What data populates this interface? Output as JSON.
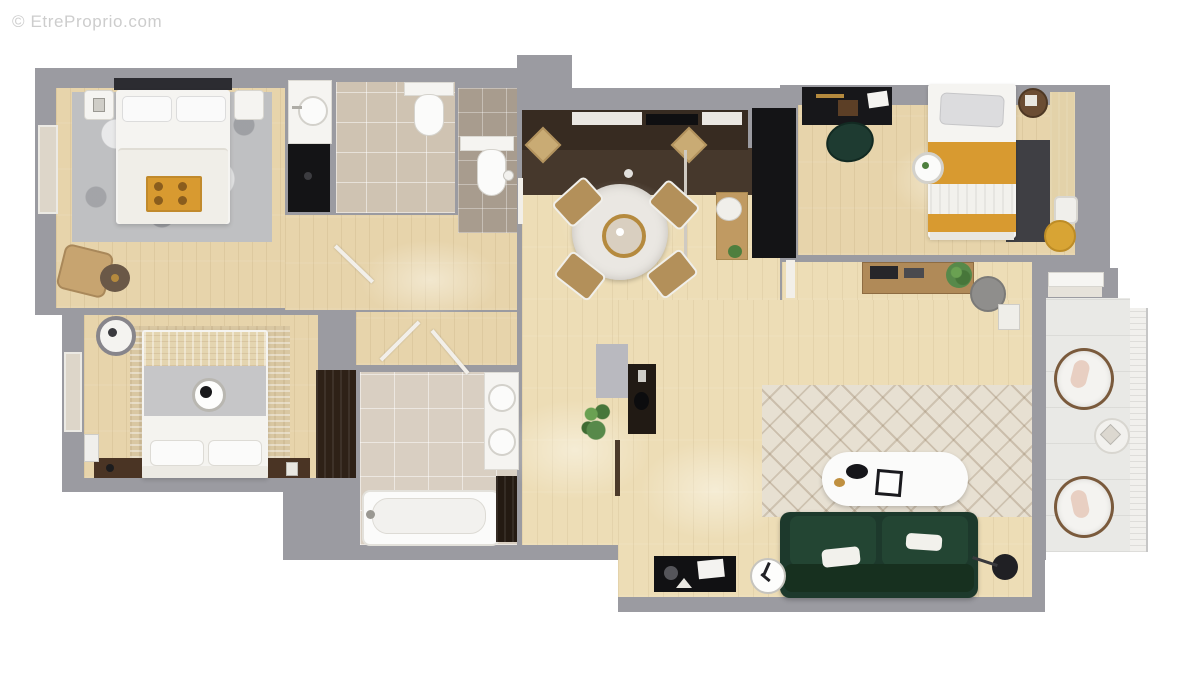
{
  "watermark": {
    "text": "© EtreProprio.com"
  },
  "colors": {
    "outside": "#ffffff",
    "wall": "#9b9ba1",
    "wood": "#e7d4ab",
    "woodLight": "#edddb6",
    "kitchenFloor": "#46382c",
    "cabinet": "#372b21",
    "espresso": "#2e2117",
    "black": "#141416",
    "white": "#f5f4f1",
    "marble": "#eae7e2",
    "tile": "#cfc3b2",
    "tileBath": "#d9cfc2",
    "tileDark": "#a89c8e",
    "balconyFloor": "#e9e9e6",
    "railing": "#f1f0ed",
    "rugGray": "#bfc0c2",
    "rugBeige": "#d9c7a2",
    "rugCharcoal": "#3f3f44",
    "rugCream": "#e7e0d2",
    "sofaGreen": "#1d392c",
    "sofaGreenLight": "#234533",
    "mustard": "#d89a30",
    "gold": "#b58a3e",
    "plant": "#4e7f3e",
    "doorLight": "#f2efe9",
    "doorDark": "#4c3a2a",
    "stoolWood": "#c9ab74",
    "chairWood": "#b3905a",
    "deskWood": "#c09a62",
    "consoleWood": "#b08a58",
    "nightDark": "#4a3424",
    "tanChair": "#c7a470",
    "sideDark": "#6a5847",
    "poufGray": "#8f8e8c",
    "poufYellow": "#d8a434"
  },
  "scene": {
    "type": "apartment-floor-plan-3d-top-view",
    "rooms": [
      {
        "id": "bedroom-1",
        "furniture": [
          "double-bed",
          "headboard",
          "pillows",
          "breakfast-tray",
          "nightstand-left",
          "nightstand-right",
          "gray-rug",
          "lounge-chair",
          "side-table",
          "window"
        ]
      },
      {
        "id": "bedroom-2",
        "furniture": [
          "double-bed",
          "gray-blanket",
          "decor-plate",
          "beige-rug",
          "nightstand-left",
          "nightstand-right",
          "wall-mirror",
          "radiator",
          "wardrobe-tv-panel"
        ]
      },
      {
        "id": "bedroom-3",
        "furniture": [
          "desk",
          "desk-chair",
          "single-bed",
          "mustard-throw",
          "charcoal-rug",
          "side-table",
          "round-nightstand",
          "laundry-basket",
          "yellow-pouf",
          "wardrobe-strip"
        ]
      },
      {
        "id": "bathroom-shower-room",
        "furniture": [
          "vanity-sink",
          "dark-shower-floor"
        ]
      },
      {
        "id": "bathroom-1",
        "furniture": [
          "toilet",
          "door"
        ]
      },
      {
        "id": "wc",
        "furniture": [
          "toilet",
          "shower-head"
        ]
      },
      {
        "id": "bathroom-2",
        "furniture": [
          "bathtub",
          "double-vanity",
          "dark-cabinet",
          "hall-wardrobe"
        ]
      },
      {
        "id": "kitchen",
        "furniture": [
          "cabinet-run",
          "marble-counter",
          "cooktop",
          "bar-stool",
          "bar-stool",
          "tall-wardrobe-column",
          "pendant-light"
        ]
      },
      {
        "id": "dining",
        "furniture": [
          "round-marble-table",
          "chair",
          "chair",
          "chair",
          "chair",
          "desk",
          "desk-chair"
        ]
      },
      {
        "id": "living-room",
        "furniture": [
          "chevron-rug",
          "oval-coffee-table",
          "green-sofa",
          "tv-console",
          "clock",
          "floor-lamp",
          "black-shelf",
          "plant",
          "wood-console",
          "gray-pouf",
          "side-table",
          "wall-stub"
        ]
      },
      {
        "id": "hallway",
        "furniture": [
          "doors",
          "plant"
        ]
      },
      {
        "id": "balcony",
        "furniture": [
          "armchair",
          "armchair",
          "round-table",
          "railing",
          "balcony-door"
        ]
      }
    ]
  }
}
